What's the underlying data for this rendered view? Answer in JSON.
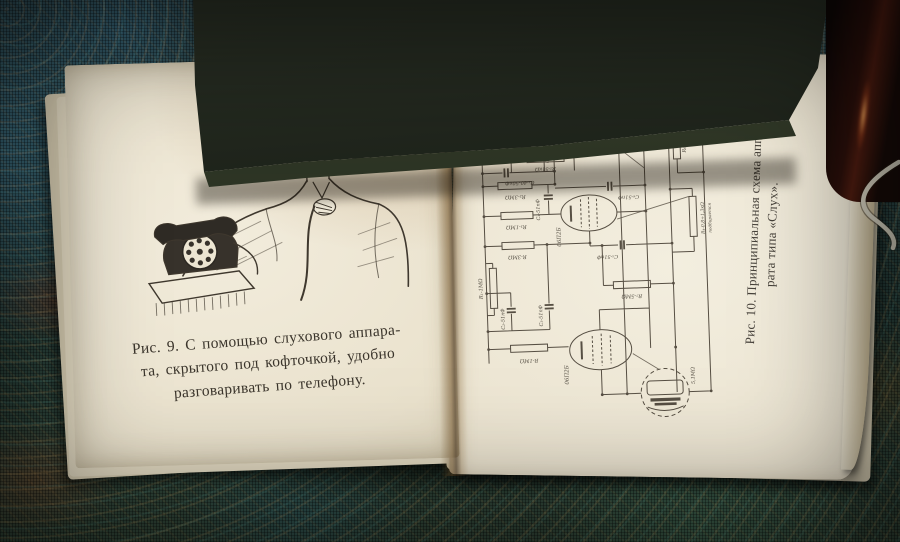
{
  "left_page": {
    "caption": {
      "line1": "Рис. 9. С помощью слухового аппара-",
      "line2": "та, скрытого под кофточкой, удобно",
      "line3": "разговаривать по телефону."
    }
  },
  "right_page": {
    "caption": {
      "line1": "Рис. 10. Принципиальная схема аппа-",
      "line2": "рата типа «Слух»."
    },
    "schematic": {
      "terminal_left": "+",
      "terminal_1": "+",
      "terminal_2": "+",
      "terminal_3": "−",
      "telefon": "Телефон",
      "winding_top": "3000 вит ПЭ 0,06",
      "winding_bottom": "3000 вит ПЭ 0,06",
      "r8": "R₈-3МΩ",
      "tube1": "06П2Б",
      "tube2": "06П2Б",
      "tube3": "06П2Б",
      "r5": "R₅-51кΩ",
      "c1": "C₁-40-50пФ",
      "r2": "R₂-3МΩ",
      "c4": "C₄-51пФ",
      "c6": "C₆-51пФ",
      "r3": "R₃-1МΩ",
      "r_mid": "R-3МΩ",
      "c5": "C₅-51пФ",
      "r7": "R₇-5МΩ",
      "r1": "R₁-1МΩ",
      "c2": "C₂-51пФ",
      "c3": "C₃-51пФ",
      "r_bottom": "R-1МΩ",
      "r6": "R₆-2кΩ",
      "r4_line1": "R₄-0,8÷1,3кΩ",
      "r4_line2": "подбирается",
      "mic": "5,1МΩ"
    }
  }
}
